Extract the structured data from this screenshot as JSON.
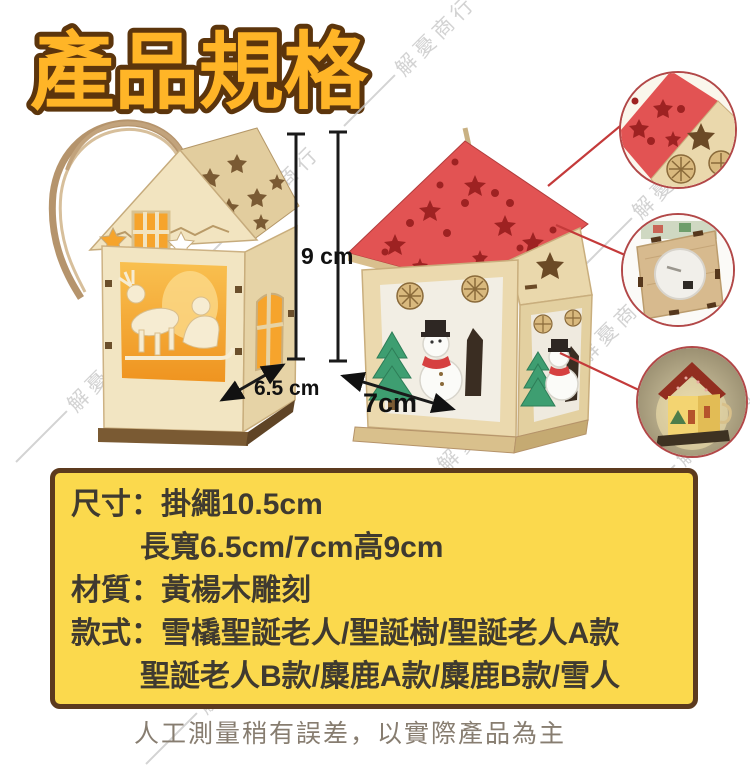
{
  "title": "產品規格",
  "watermark": "解憂商行",
  "annotations": {
    "height": "9 cm",
    "width_left": "6.5 cm",
    "width_right": "7cm"
  },
  "specs": {
    "size_label": "尺寸：",
    "size_value": "掛繩10.5cm",
    "size_value2": "長寬6.5cm/7cm高9cm",
    "material_label": "材質：",
    "material_value": "黃楊木雕刻",
    "style_label": "款式：",
    "style_value": "雪橇聖誕老人/聖誕樹/聖誕老人A款",
    "style_value2": "聖誕老人B款/麋鹿A款/麋鹿B款/雪人"
  },
  "disclaimer": "人工測量稍有誤差，以實際產品為主",
  "colors": {
    "title_fill": "#FFB527",
    "title_outline": "#5C350C",
    "box_bg": "#FBD94D",
    "box_border": "#5C3A1E",
    "box_text": "#3F3A30",
    "roof_red": "#E25353",
    "wood_tan": "#EBD9AE",
    "glow_orange": "#F6A42C",
    "callout_red": "#C43A3A",
    "dimension_black": "#111111",
    "disclaimer_text": "#877D70",
    "watermark_gray": "#C9C9C9"
  }
}
